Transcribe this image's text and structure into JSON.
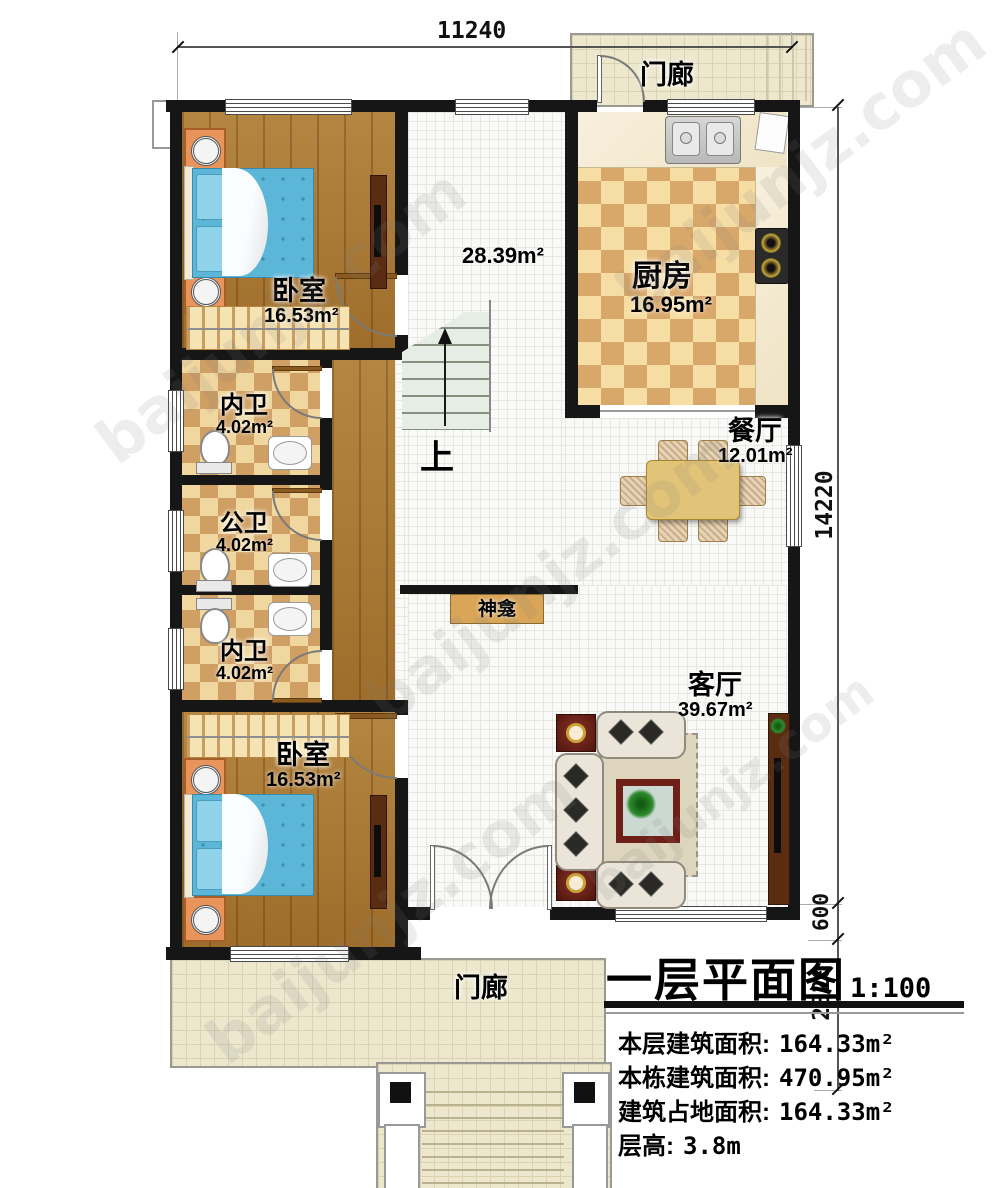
{
  "plan": {
    "dims": {
      "top": "11240",
      "right": "14220",
      "right_lower_a": "600",
      "right_lower_b": "2820"
    },
    "rooms": {
      "porch_top": {
        "name": "门廊"
      },
      "kitchen": {
        "name": "厨房",
        "area": "16.95m²"
      },
      "dining": {
        "name": "餐厅",
        "area": "12.01m²"
      },
      "living": {
        "name": "客厅",
        "area": "39.67m²"
      },
      "hall": {
        "area": "28.39m²"
      },
      "stairs": {
        "up": "上"
      },
      "shrine": {
        "name": "神龛"
      },
      "bedroom_top": {
        "name": "卧室",
        "area": "16.53m²"
      },
      "bath_top": {
        "name": "内卫",
        "area": "4.02m²"
      },
      "bath_middle": {
        "name": "公卫",
        "area": "4.02m²"
      },
      "bath_bottom": {
        "name": "内卫",
        "area": "4.02m²"
      },
      "bedroom_bottom": {
        "name": "卧室",
        "area": "16.53m²"
      },
      "porch_bottom": {
        "name": "门廊"
      }
    },
    "title_block": {
      "title": "一层平面图",
      "scale": "1:100",
      "info": [
        {
          "label": "本层建筑面积:",
          "value": "164.33m²"
        },
        {
          "label": "本栋建筑面积:",
          "value": "470.95m²"
        },
        {
          "label": "建筑占地面积:",
          "value": "164.33m²"
        },
        {
          "label": "层高:",
          "value": "3.8m"
        }
      ]
    },
    "watermark": "baijunjz.com",
    "colors": {
      "wall": "#161616",
      "wood_floor": "#a87732",
      "checker_light": "#f0d7a0",
      "checker_dark": "#cf9f63",
      "porch_tile": "#ede7ce",
      "bed_blue": "#5cb6d8",
      "accent_red": "#6e2018",
      "shrine_tan": "#d9a557"
    }
  }
}
